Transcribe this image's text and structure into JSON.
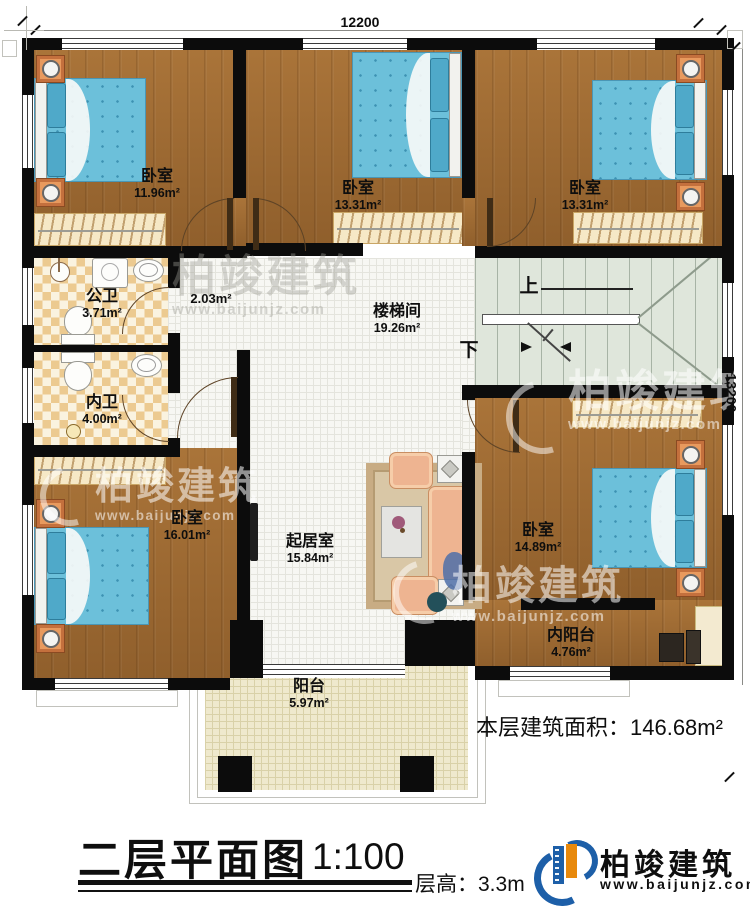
{
  "plan": {
    "dimensions": {
      "top": "12200",
      "right": "13200"
    },
    "rooms": [
      {
        "name": "卧室",
        "area": "11.96m²"
      },
      {
        "name": "卧室",
        "area": "13.31m²"
      },
      {
        "name": "卧室",
        "area": "13.31m²"
      },
      {
        "name": "公卫",
        "area": "3.71m²"
      },
      {
        "name": "",
        "area": "2.03m²"
      },
      {
        "name": "内卫",
        "area": "4.00m²"
      },
      {
        "name": "楼梯间",
        "area": "19.26m²"
      },
      {
        "name": "卧室",
        "area": "16.01m²"
      },
      {
        "name": "起居室",
        "area": "15.84m²"
      },
      {
        "name": "卧室",
        "area": "14.89m²"
      },
      {
        "name": "内阳台",
        "area": "4.76m²"
      },
      {
        "name": "阳台",
        "area": "5.97m²"
      }
    ],
    "stairs": {
      "up": "上",
      "down": "下"
    }
  },
  "watermark": {
    "brand": "柏竣建筑",
    "url": "www.baijunjz.com"
  },
  "footer": {
    "title": "二层平面图",
    "scale": "1:100",
    "floor_height": "层高：3.3m",
    "total_area": "本层建筑面积：146.68m²",
    "brand": "柏竣建筑",
    "brand_url": "www.baijunjz.com"
  }
}
